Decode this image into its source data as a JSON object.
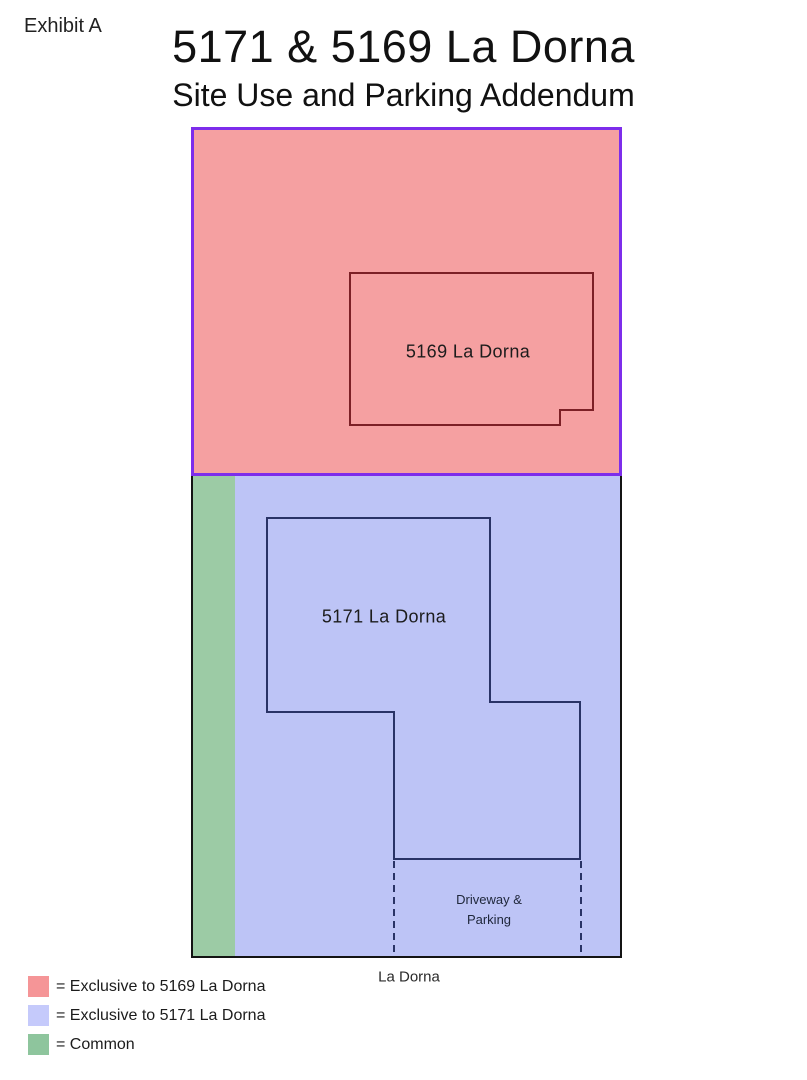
{
  "header": {
    "exhibit": "Exhibit A",
    "title": "5171 & 5169 La Dorna",
    "subtitle": "Site Use and Parking Addendum"
  },
  "site_plan": {
    "building_5169_label": "5169 La Dorna",
    "building_5171_label": "5171 La Dorna",
    "driveway_label": "Driveway &\nParking",
    "street_label": "La Dorna"
  },
  "legend": {
    "items": [
      {
        "name": "exclusive-5169",
        "label": "= Exclusive to 5169 La Dorna",
        "color": "#f59597"
      },
      {
        "name": "exclusive-5171",
        "label": "= Exclusive to 5171 La Dorna",
        "color": "#c5cafb"
      },
      {
        "name": "common",
        "label": "= Common",
        "color": "#8ec59d"
      }
    ]
  },
  "colors": {
    "parcel_5169_fill": "#f5a0a1",
    "parcel_5169_border": "#7d2deb",
    "building_5169_outline": "#7c2026",
    "parcel_5171_fill": "#bdc4f6",
    "parcel_5171_border": "#141414",
    "building_5171_outline": "#293366",
    "common_fill": "#9ccba5",
    "driveway_dash": "#293366"
  }
}
